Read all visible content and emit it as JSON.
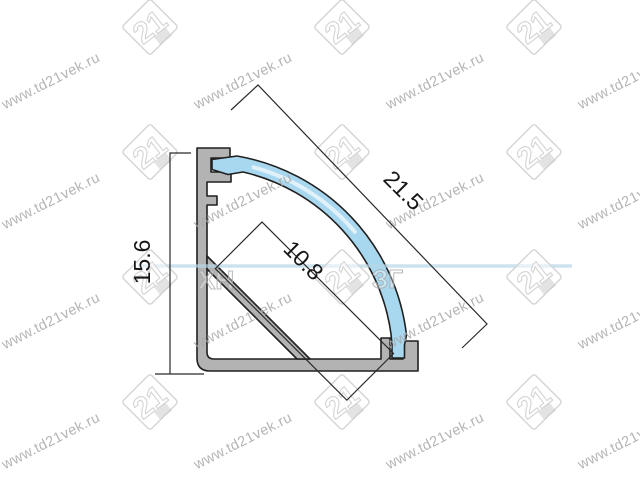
{
  "drawing": {
    "title": "corner-led-profile-cross-section",
    "dimensions": {
      "height": "15.6",
      "diagonal": "21.5",
      "inner_width": "10.8"
    }
  },
  "watermark": {
    "site_text": "www.td21vek.ru",
    "logo_text": "21",
    "text_rotation_deg": -27,
    "text_columns_x": [
      53,
      245,
      437,
      629
    ],
    "text_rows_y": [
      85,
      205,
      325,
      445
    ],
    "logo_columns_x": [
      150,
      342,
      534
    ],
    "logo_rows_y": [
      27,
      152,
      277,
      402
    ],
    "center_band": {
      "x1": 138,
      "y1": 266,
      "x2": 572,
      "y2": 266
    },
    "center_fragments": [
      {
        "text": "ХН",
        "x": 198,
        "y": 289
      },
      {
        "text": "ЗГ",
        "x": 372,
        "y": 288
      }
    ]
  },
  "colors": {
    "background": "#ffffff",
    "aluminum": "#b3b3b3",
    "diffuser": "#a8d8ef",
    "outline": "#202020",
    "dimension": "#161616",
    "wmtext": "#a8a8a8",
    "wmlogo": "#d4d4d4",
    "band": "#b7d7e8"
  }
}
